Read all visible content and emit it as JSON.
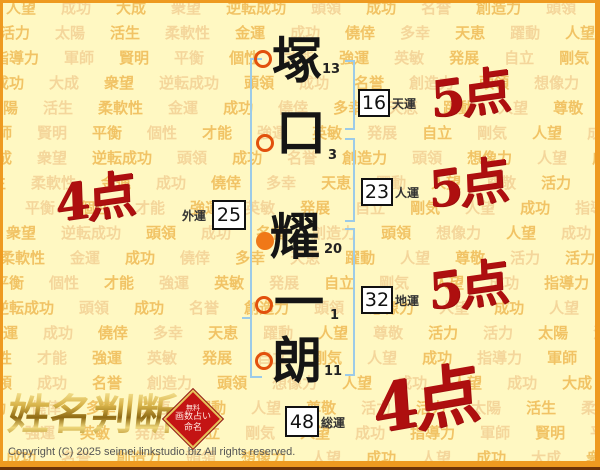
{
  "page": {
    "logo_text": "姓名判断",
    "badge": {
      "line1": "無料",
      "line2": "画数占い",
      "line3": "命名"
    },
    "copyright": "Copyright (C) 2025 seimei.linkstudio.biz All rights reserved."
  },
  "name": {
    "characters": [
      {
        "char": "塚",
        "strokes": "13",
        "marker": "outline"
      },
      {
        "char": "口",
        "strokes": "3",
        "marker": "outline"
      },
      {
        "char": "耀",
        "strokes": "20",
        "marker": "filled"
      },
      {
        "char": "一",
        "strokes": "1",
        "marker": "outline"
      },
      {
        "char": "朗",
        "strokes": "11",
        "marker": "outline"
      }
    ]
  },
  "results": {
    "tenun": {
      "label": "天運",
      "value": "16",
      "score": "5点"
    },
    "jinun": {
      "label": "人運",
      "value": "23",
      "score": "5点"
    },
    "chiun": {
      "label": "地運",
      "value": "32",
      "score": "5点"
    },
    "gaiun": {
      "label": "外運",
      "value": "25",
      "score": "4点"
    },
    "soun": {
      "label": "総運",
      "value": "48",
      "score": "4点"
    }
  },
  "background": {
    "row_count": 19,
    "row_pitch": 25,
    "sequences": [
      [
        "人望",
        "成功",
        "大成",
        "衆望",
        "逆転成功",
        "頭領",
        "成功",
        "名誉",
        "創造力",
        "頭領",
        "想像力",
        "人望",
        "成功"
      ],
      [
        "活力",
        "太陽",
        "活生",
        "柔軟性",
        "金運",
        "成功",
        "僥倖",
        "多幸",
        "天恵",
        "躍動",
        "人望",
        "尊敬",
        "活力"
      ],
      [
        "指導力",
        "軍師",
        "賢明",
        "平衡",
        "個性",
        "才能",
        "強運",
        "英敏",
        "発展",
        "自立",
        "剛気",
        "人望",
        "成功"
      ]
    ]
  },
  "colors": {
    "page_bg": "#FFF8C2",
    "frame_orange": "#EE9A20",
    "bracket_blue": "#9CCBE8",
    "marker_orange": "#E2500C",
    "score_red": "#AE0F0F",
    "badge_red": "#C41414",
    "bg_word": "#EEB74F"
  }
}
